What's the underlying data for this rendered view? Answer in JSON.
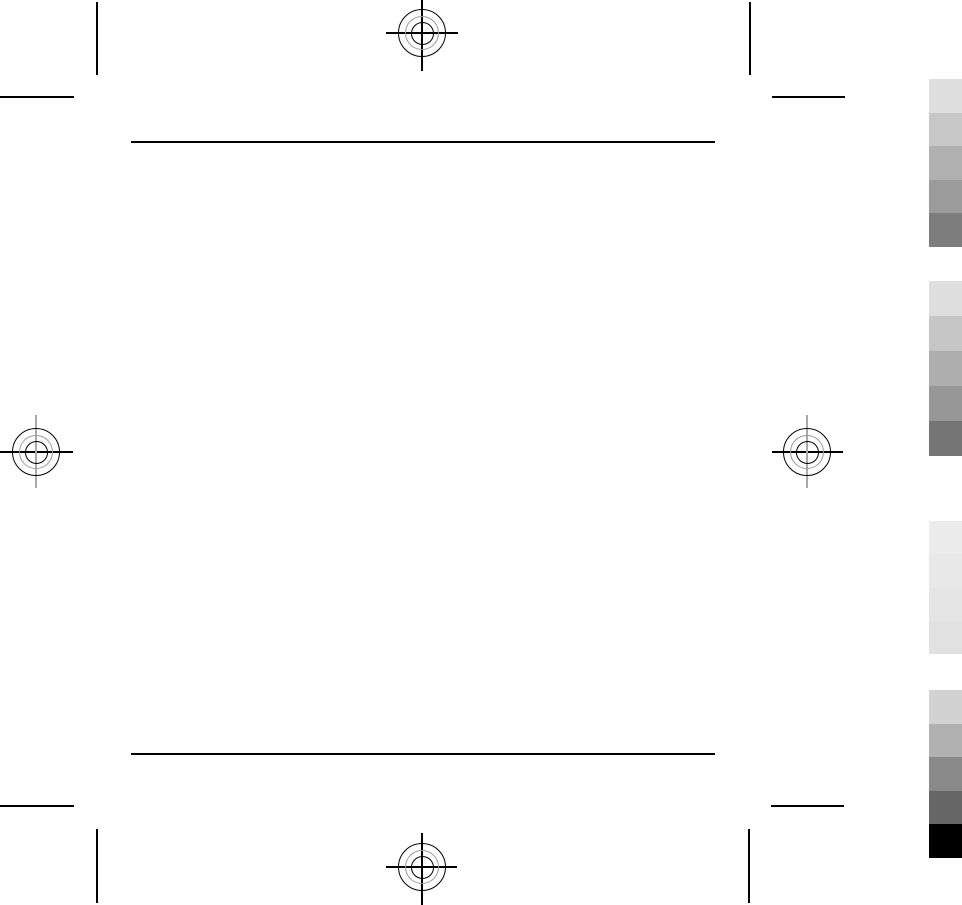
{
  "colors": {
    "page_background": "#ffffff",
    "mark_black": "#000000",
    "ring_gray": "#999999",
    "crosshair_gray": "#a9a9a9"
  },
  "calibration_bars": {
    "groups": [
      {
        "name": "gray-scale-top",
        "swatches": [
          "#dedede",
          "#c7c7c7",
          "#b0b0b0",
          "#9b9b9b",
          "#7d7d7d"
        ]
      },
      {
        "name": "gray-scale-upper-mid",
        "swatches": [
          "#dedede",
          "#c6c6c6",
          "#aeaeae",
          "#979797",
          "#757575"
        ]
      },
      {
        "name": "gray-scale-light",
        "swatches": [
          "#ececec",
          "#e8e8e8",
          "#e4e4e4",
          "#e1e1e1"
        ]
      },
      {
        "name": "gray-scale-bottom",
        "swatches": [
          "#d2d2d2",
          "#b0b0b0",
          "#898989",
          "#666666",
          "#000000"
        ]
      }
    ]
  }
}
